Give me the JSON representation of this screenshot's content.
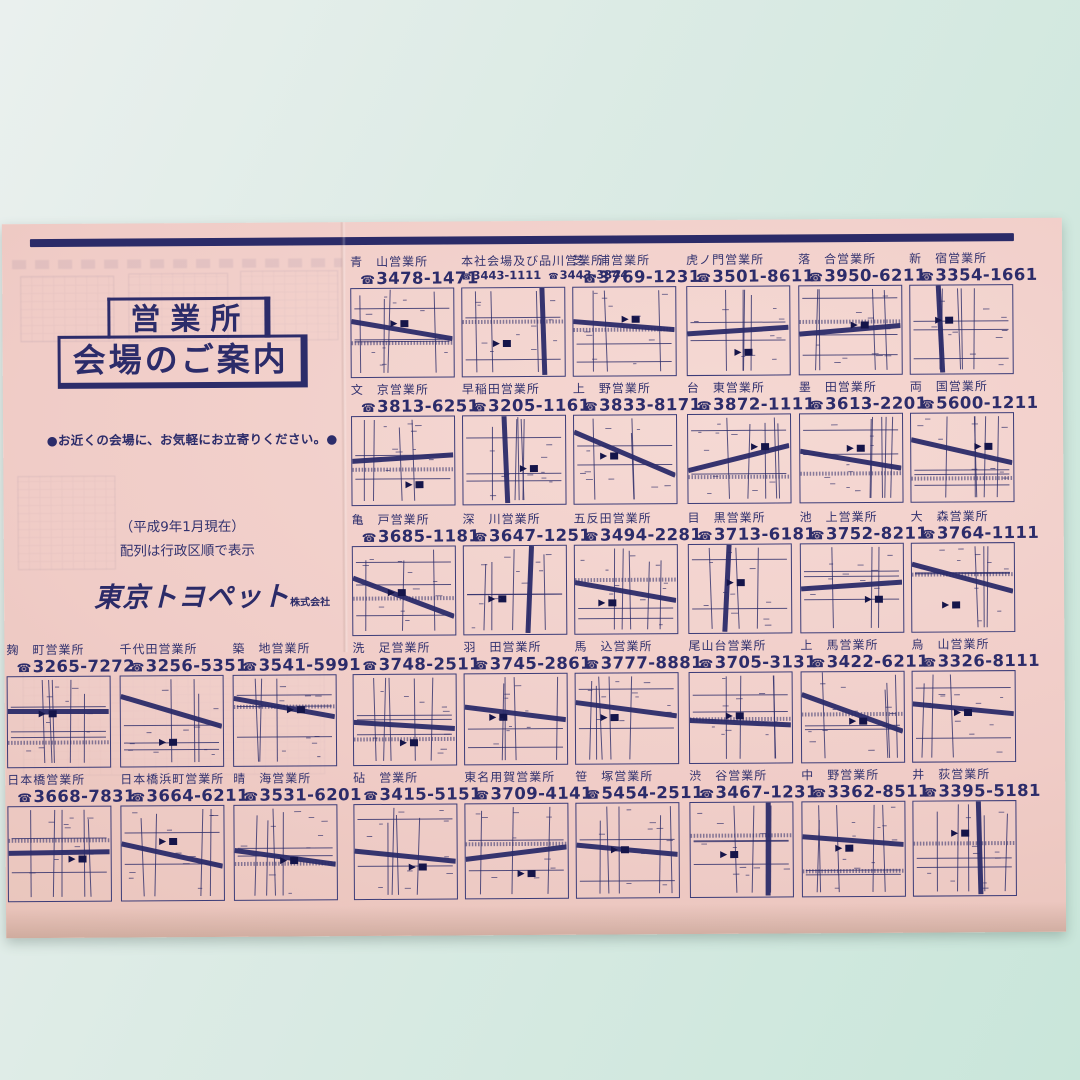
{
  "page": {
    "title_box": {
      "line1": "営業所",
      "line2": "会場のご案内"
    },
    "tagline": "●お近くの会場に、お気軽にお立寄りください。●",
    "note_line1": "（平成9年1月現在）",
    "note_line2": "配列は行政区順で表示",
    "logo": {
      "name": "東京トヨペット",
      "suffix": "株式会社"
    },
    "phone_icon": "☎",
    "ink_color": "#2c2c6a",
    "paper_color": "#f0ccc7",
    "backdrop_color": "#d9e8e2"
  },
  "offices": [
    {
      "name": "青　山営業所",
      "phone": "3478-1471",
      "row": 1,
      "col": 3
    },
    {
      "name": "本社会場及び品川営業所",
      "phone": "3443-1111",
      "phone2": "3443-3344",
      "row": 1,
      "col": 4
    },
    {
      "name": "芝　浦営業所",
      "phone": "3769-1231",
      "row": 1,
      "col": 5
    },
    {
      "name": "虎ノ門営業所",
      "phone": "3501-8611",
      "row": 1,
      "col": 6
    },
    {
      "name": "落　合営業所",
      "phone": "3950-6211",
      "row": 1,
      "col": 7
    },
    {
      "name": "新　宿営業所",
      "phone": "3354-1661",
      "row": 1,
      "col": 8
    },
    {
      "name": "文　京営業所",
      "phone": "3813-6251",
      "row": 2,
      "col": 3
    },
    {
      "name": "早稲田営業所",
      "phone": "3205-1161",
      "row": 2,
      "col": 4
    },
    {
      "name": "上　野営業所",
      "phone": "3833-8171",
      "row": 2,
      "col": 5
    },
    {
      "name": "台　東営業所",
      "phone": "3872-1111",
      "row": 2,
      "col": 6
    },
    {
      "name": "墨　田営業所",
      "phone": "3613-2201",
      "row": 2,
      "col": 7
    },
    {
      "name": "両　国営業所",
      "phone": "5600-1211",
      "row": 2,
      "col": 8
    },
    {
      "name": "亀　戸営業所",
      "phone": "3685-1181",
      "row": 3,
      "col": 3
    },
    {
      "name": "深　川営業所",
      "phone": "3647-1251",
      "row": 3,
      "col": 4
    },
    {
      "name": "五反田営業所",
      "phone": "3494-2281",
      "row": 3,
      "col": 5
    },
    {
      "name": "目　黒営業所",
      "phone": "3713-6181",
      "row": 3,
      "col": 6
    },
    {
      "name": "池　上営業所",
      "phone": "3752-8211",
      "row": 3,
      "col": 7
    },
    {
      "name": "大　森営業所",
      "phone": "3764-1111",
      "row": 3,
      "col": 8
    },
    {
      "name": "麹　町営業所",
      "phone": "3265-7272",
      "row": 4,
      "col": 0
    },
    {
      "name": "千代田営業所",
      "phone": "3256-5351",
      "row": 4,
      "col": 1
    },
    {
      "name": "築　地営業所",
      "phone": "3541-5991",
      "row": 4,
      "col": 2
    },
    {
      "name": "洗　足営業所",
      "phone": "3748-2511",
      "row": 4,
      "col": 3
    },
    {
      "name": "羽　田営業所",
      "phone": "3745-2861",
      "row": 4,
      "col": 4
    },
    {
      "name": "馬　込営業所",
      "phone": "3777-8881",
      "row": 4,
      "col": 5
    },
    {
      "name": "尾山台営業所",
      "phone": "3705-3131",
      "row": 4,
      "col": 6
    },
    {
      "name": "上　馬営業所",
      "phone": "3422-6211",
      "row": 4,
      "col": 7
    },
    {
      "name": "烏　山営業所",
      "phone": "3326-8111",
      "row": 4,
      "col": 8
    },
    {
      "name": "日本橋営業所",
      "phone": "3668-7831",
      "row": 5,
      "col": 0
    },
    {
      "name": "日本橋浜町営業所",
      "phone": "3664-6211",
      "row": 5,
      "col": 1
    },
    {
      "name": "晴　海営業所",
      "phone": "3531-6201",
      "row": 5,
      "col": 2
    },
    {
      "name": "砧　営業所",
      "phone": "3415-5151",
      "row": 5,
      "col": 3
    },
    {
      "name": "東名用賀営業所",
      "phone": "3709-4141",
      "row": 5,
      "col": 4
    },
    {
      "name": "笹　塚営業所",
      "phone": "5454-2511",
      "row": 5,
      "col": 5
    },
    {
      "name": "渋　谷営業所",
      "phone": "3467-1231",
      "row": 5,
      "col": 6
    },
    {
      "name": "中　野営業所",
      "phone": "3362-8511",
      "row": 5,
      "col": 7
    },
    {
      "name": "井　荻営業所",
      "phone": "3395-5181",
      "row": 5,
      "col": 8
    }
  ]
}
